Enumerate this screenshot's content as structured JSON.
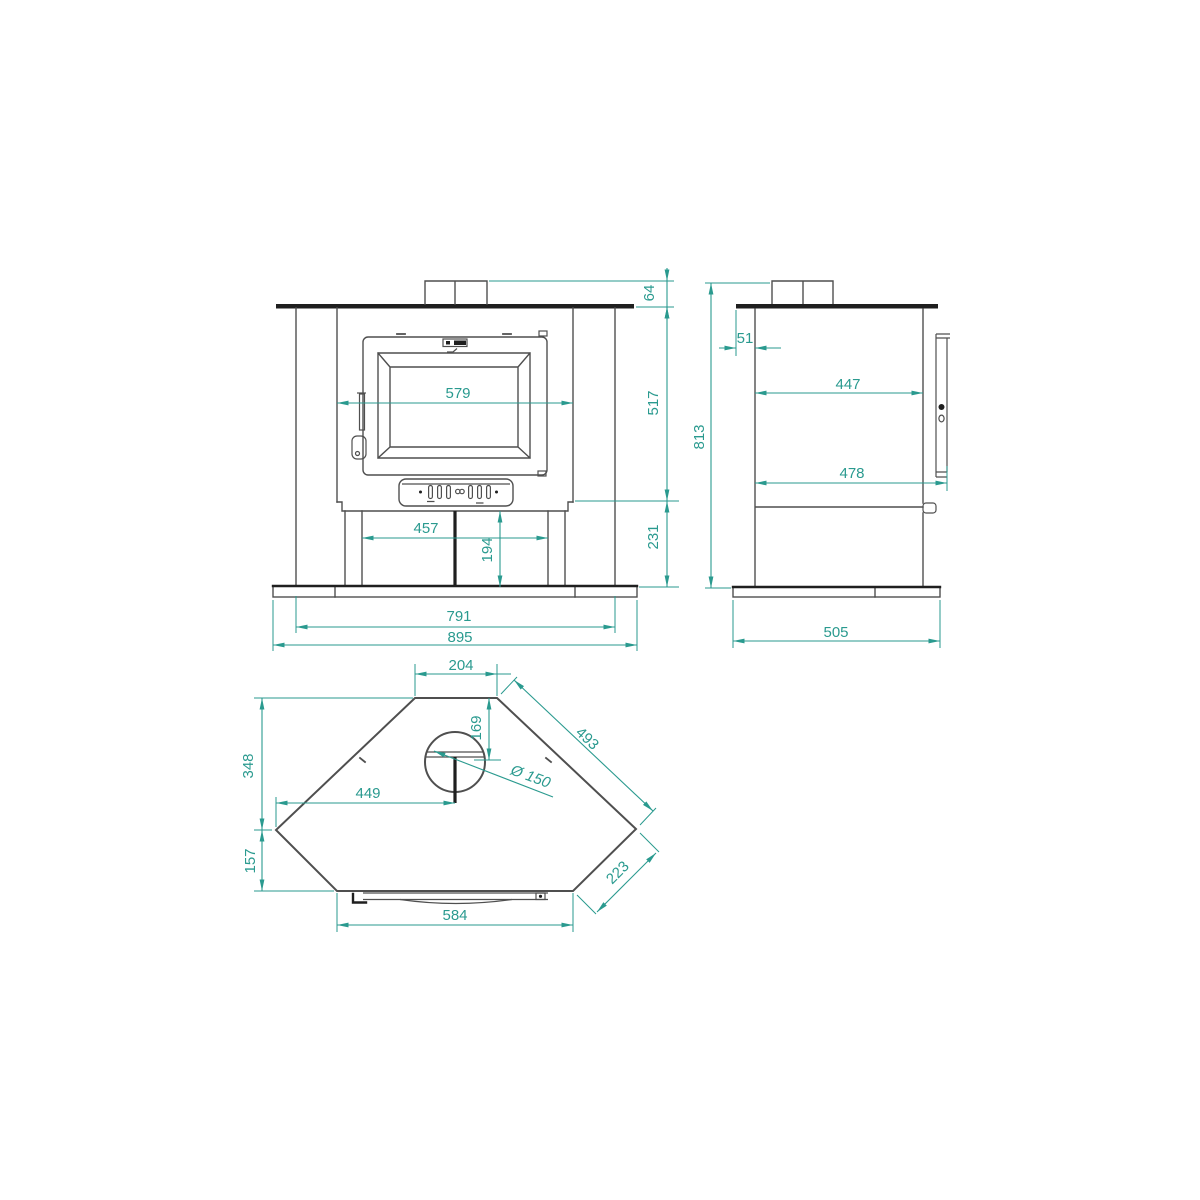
{
  "colors": {
    "background": "#ffffff",
    "line": "#4f4f4f",
    "dark": "#1f1f1f",
    "dim": "#2a9a8f"
  },
  "views": {
    "front": {
      "dims": {
        "collar_height": "64",
        "door_opening_width": "579",
        "body_height": "517",
        "plinth_height": "231",
        "base_opening_width": "457",
        "base_opening_height": "194",
        "leg_span_width": "791",
        "overall_width": "895"
      }
    },
    "side": {
      "dims": {
        "top_plate_overhang": "51",
        "body_depth": "447",
        "depth_with_door": "478",
        "overall_height": "813",
        "base_plate_depth": "505"
      }
    },
    "top": {
      "dims": {
        "back_edge_width": "204",
        "left_side_depth": "348",
        "front_corner_depth": "157",
        "flue_center_from_left": "449",
        "flue_offset_from_back": "169",
        "flue_diameter": "Ø 150",
        "right_side_edge": "493",
        "corner_edge_width": "223",
        "front_edge_width": "584"
      }
    }
  }
}
